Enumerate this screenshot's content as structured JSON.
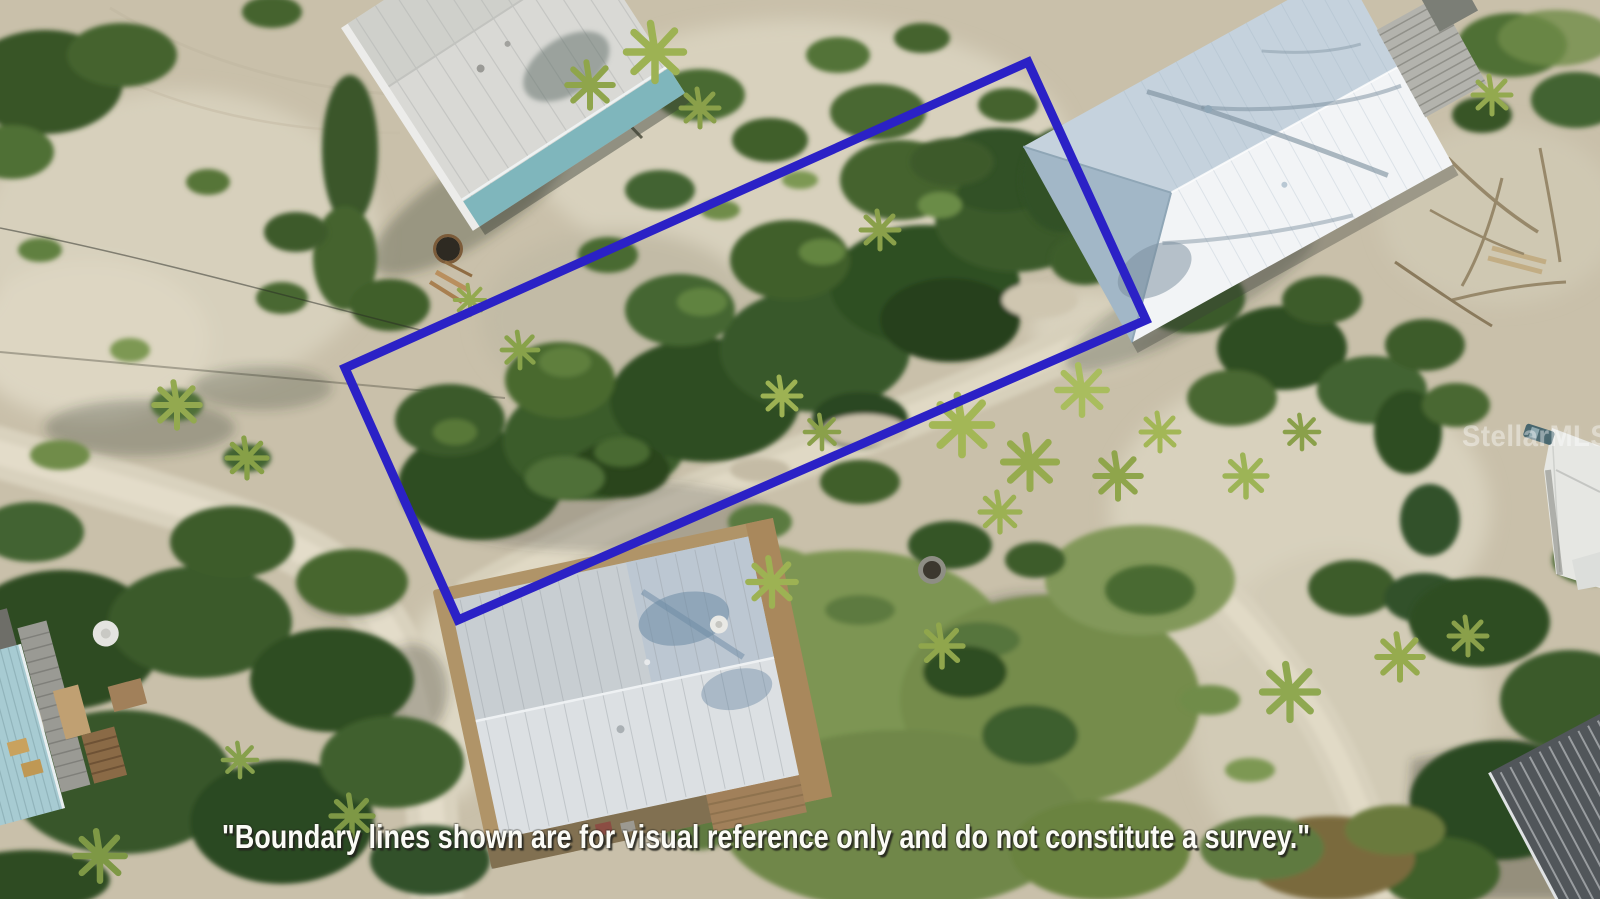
{
  "photo": {
    "watermark": "StellarMLS",
    "disclaimer": "\"Boundary lines shown are for visual reference only and do not constitute a survey.\""
  },
  "boundary": {
    "color": "#2b21c6",
    "stroke_width": 9,
    "points": "1028,62 1146,320 458,620 345,368"
  }
}
